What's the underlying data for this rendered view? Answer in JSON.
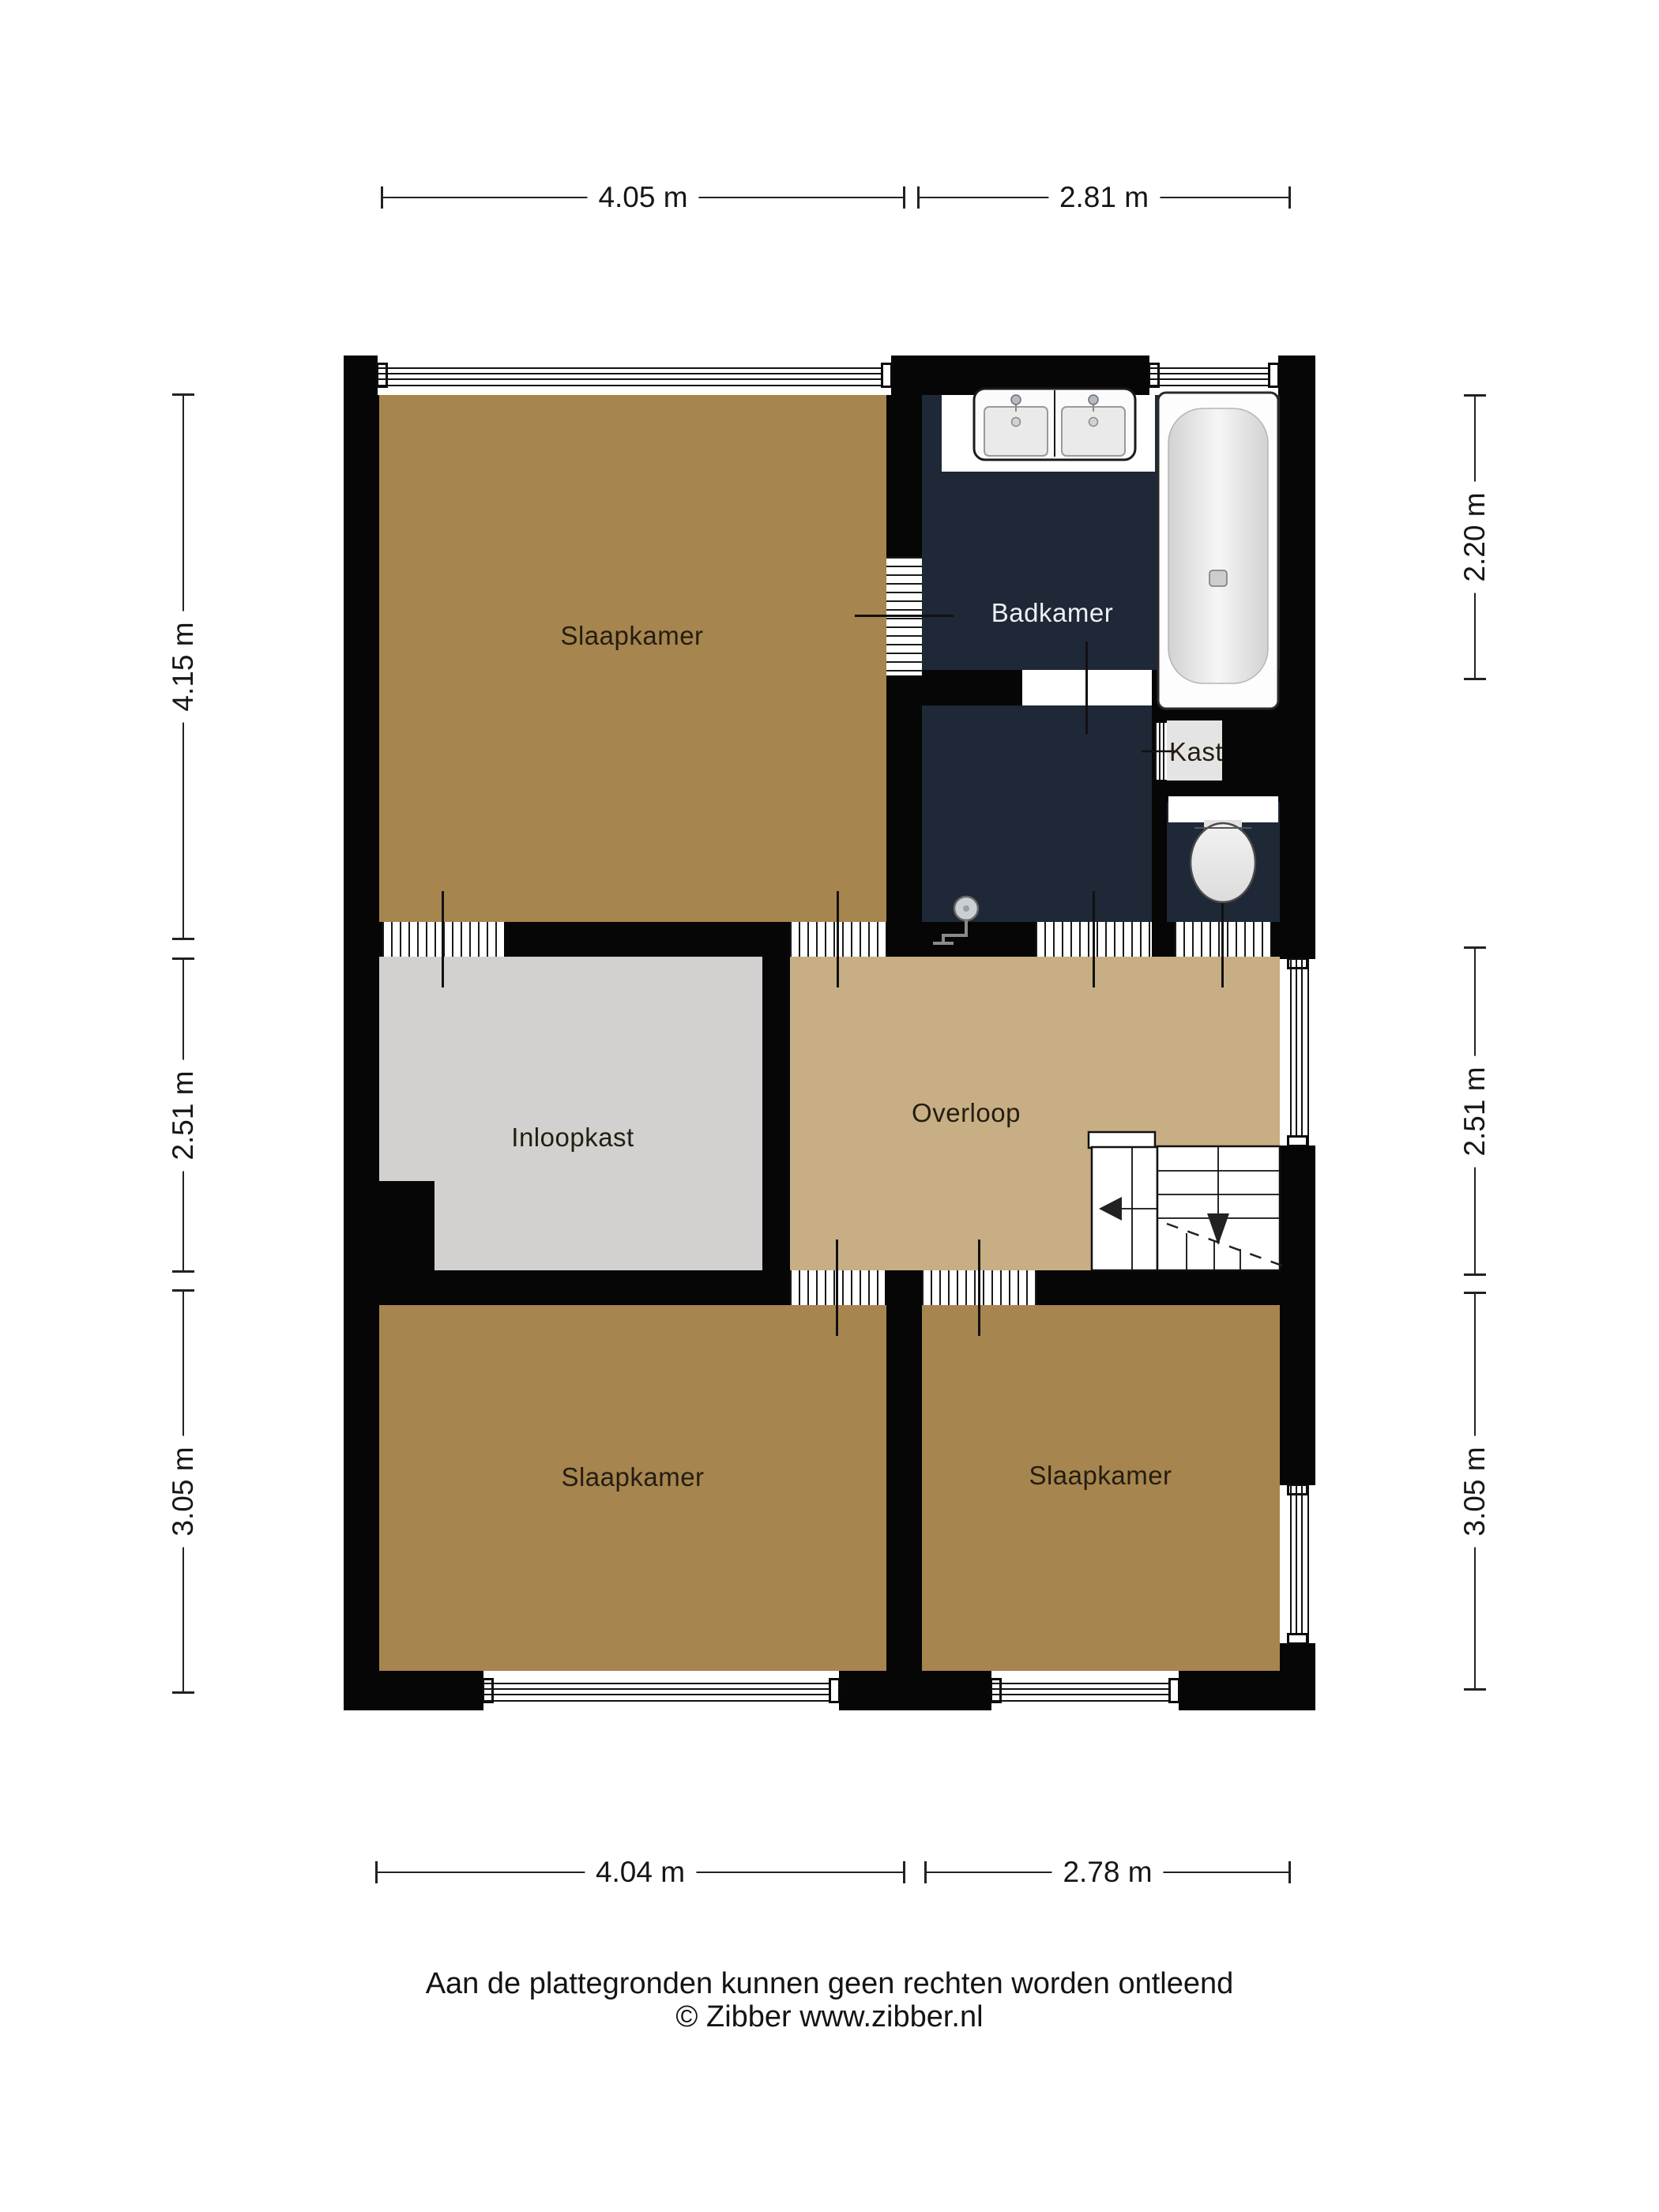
{
  "rooms": {
    "bedroom_top_left": {
      "label": "Slaapkamer"
    },
    "bathroom": {
      "label": "Badkamer"
    },
    "closet": {
      "label": "Kast"
    },
    "walk_in_closet": {
      "label": "Inloopkast"
    },
    "landing": {
      "label": "Overloop"
    },
    "bedroom_bottom_left": {
      "label": "Slaapkamer"
    },
    "bedroom_bottom_right": {
      "label": "Slaapkamer"
    }
  },
  "dimensions": {
    "top": [
      {
        "label": "4.05 m"
      },
      {
        "label": "2.81 m"
      }
    ],
    "bottom": [
      {
        "label": "4.04 m"
      },
      {
        "label": "2.78 m"
      }
    ],
    "left": [
      {
        "label": "4.15 m"
      },
      {
        "label": "2.51 m"
      },
      {
        "label": "3.05 m"
      }
    ],
    "right": [
      {
        "label": "2.20 m"
      },
      {
        "label": "2.51 m"
      },
      {
        "label": "3.05 m"
      }
    ]
  },
  "footer": {
    "line1": "Aan de plattegronden kunnen geen rechten worden ontleend",
    "line2": "© Zibber www.zibber.nl"
  },
  "colors": {
    "wall": "#060606",
    "bedroom_floor": "#a6854e",
    "landing_floor": "#c8ae84",
    "walkin_floor": "#d2d1cf",
    "closet_floor": "#e4e4e4",
    "bathroom_floor": "#1e2836",
    "label_dark": "#241d11",
    "label_light": "#edf0f4",
    "background": "#ffffff"
  }
}
